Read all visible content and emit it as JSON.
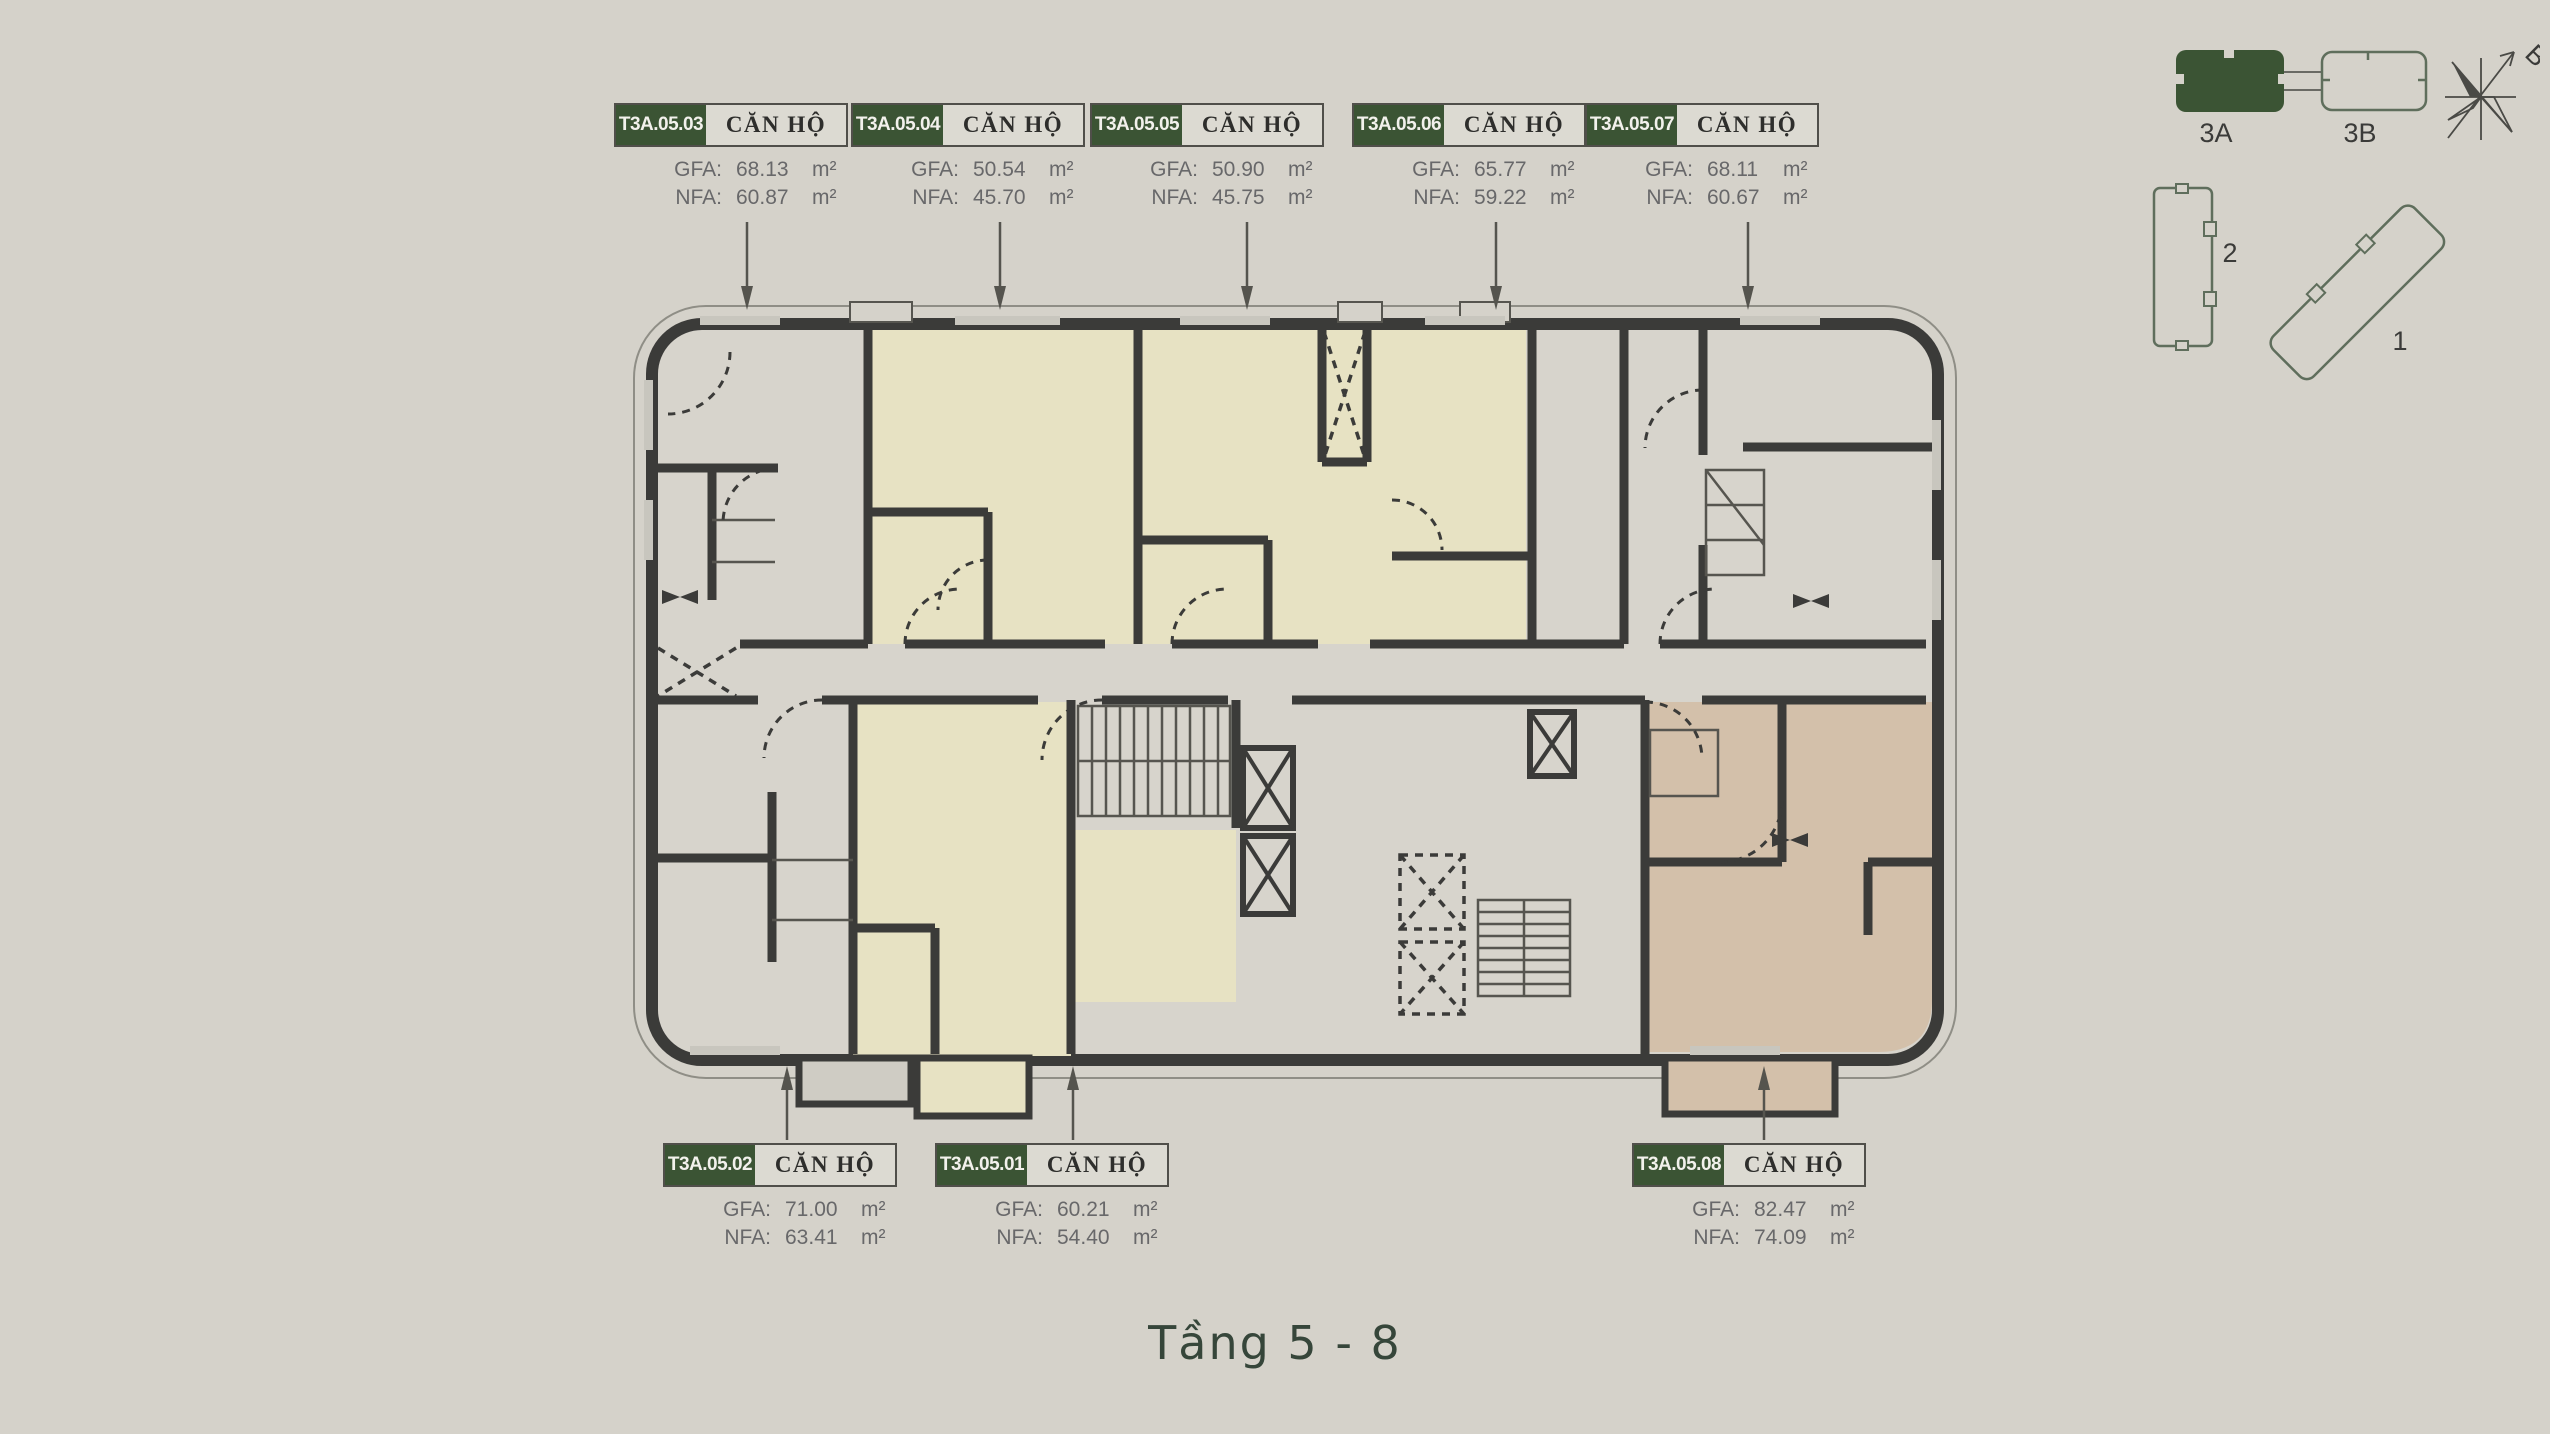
{
  "page": {
    "title": "Tầng 5 - 8"
  },
  "labels": {
    "apartment": "CĂN HỘ",
    "gfa": "GFA:",
    "nfa": "NFA:",
    "unit": "m²"
  },
  "units": {
    "top": [
      {
        "code": "T3A.05.03",
        "gfa": "68.13",
        "nfa": "60.87"
      },
      {
        "code": "T3A.05.04",
        "gfa": "50.54",
        "nfa": "45.70"
      },
      {
        "code": "T3A.05.05",
        "gfa": "50.90",
        "nfa": "45.75"
      },
      {
        "code": "T3A.05.06",
        "gfa": "65.77",
        "nfa": "59.22"
      },
      {
        "code": "T3A.05.07",
        "gfa": "68.11",
        "nfa": "60.67"
      }
    ],
    "bottom": [
      {
        "code": "T3A.05.02",
        "gfa": "71.00",
        "nfa": "63.41"
      },
      {
        "code": "T3A.05.01",
        "gfa": "60.21",
        "nfa": "54.40"
      },
      {
        "code": "T3A.05.08",
        "gfa": "82.47",
        "nfa": "74.09"
      }
    ]
  },
  "minimap": {
    "tower_3a": "3A",
    "tower_3b": "3B",
    "building_2": "2",
    "building_1": "1",
    "compass_north": "B"
  },
  "colors": {
    "background": "#d5d2ca",
    "accent_green": "#3b5434",
    "unit_cream": "#e7e2c3",
    "unit_tan": "#d3c0aa",
    "wall": "#3b3b39",
    "title_text": "#36463a"
  }
}
